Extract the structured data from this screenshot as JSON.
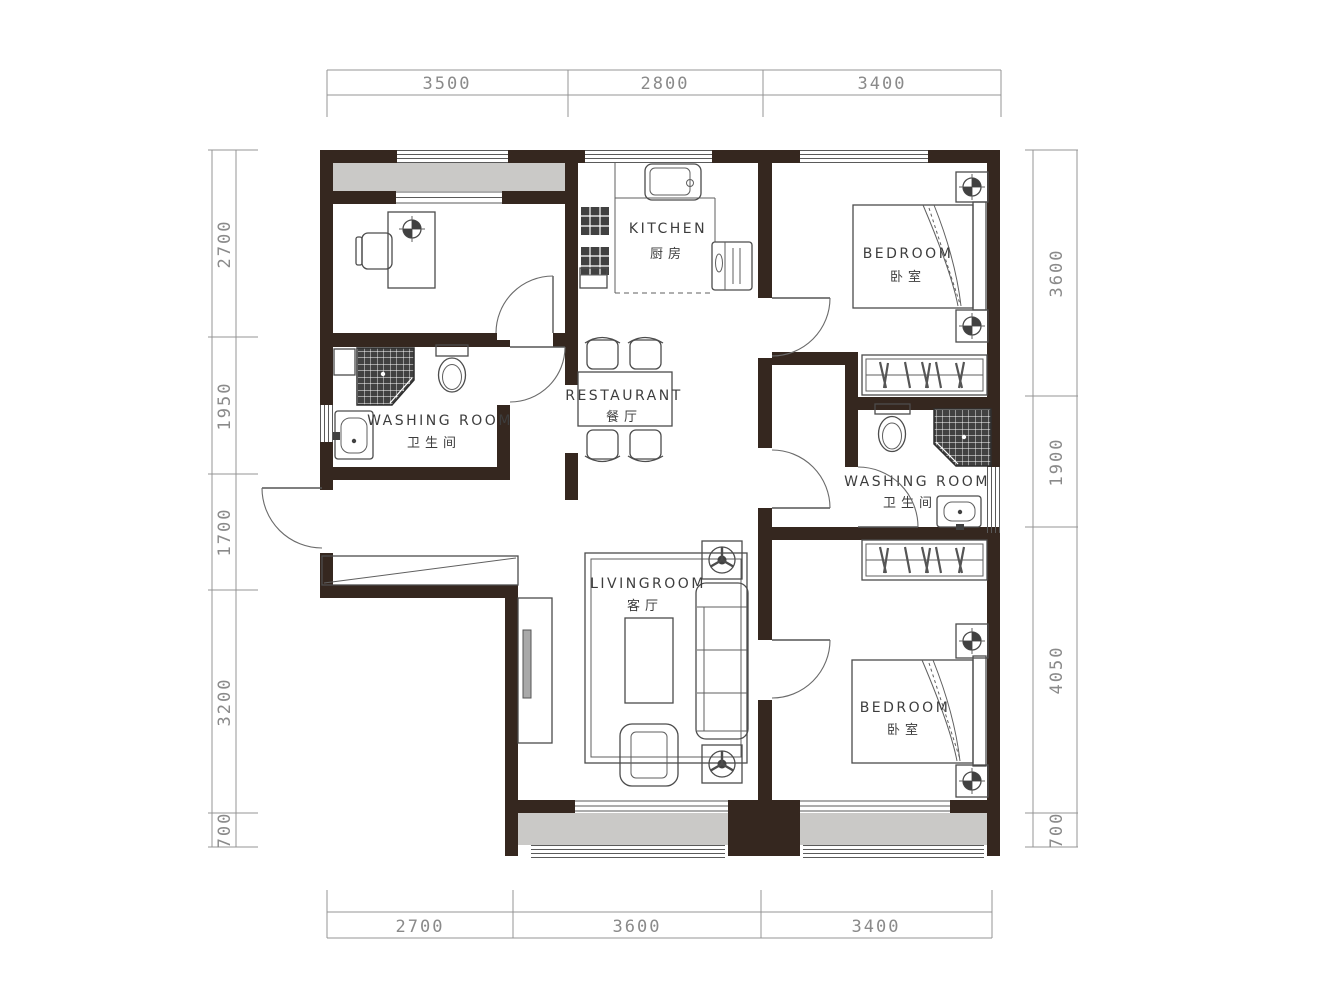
{
  "rooms": {
    "kitchen": {
      "en": "KITCHEN",
      "cn": "厨房"
    },
    "restaurant": {
      "en": "RESTAURANT",
      "cn": "餐厅"
    },
    "livingroom": {
      "en": "LIVINGROOM",
      "cn": "客厅"
    },
    "bedroom_top": {
      "en": "BEDROOM",
      "cn": "卧室"
    },
    "bedroom_bottom": {
      "en": "BEDROOM",
      "cn": "卧室"
    },
    "washroom_left": {
      "en": "WASHING ROOM",
      "cn": "卫生间"
    },
    "washroom_right": {
      "en": "WASHING ROOM",
      "cn": "卫生间"
    }
  },
  "dimensions": {
    "top": [
      "3500",
      "2800",
      "3400"
    ],
    "bottom": [
      "2700",
      "3600",
      "3400"
    ],
    "left": [
      "2700",
      "1950",
      "1700",
      "3200",
      "700"
    ],
    "right": [
      "3600",
      "1900",
      "4050",
      "700"
    ]
  },
  "colors": {
    "wall": "#35271f",
    "balcony_floor": "#cac9c7",
    "furniture_line": "#4c4c4c",
    "dimension": "#8a8a8a"
  }
}
